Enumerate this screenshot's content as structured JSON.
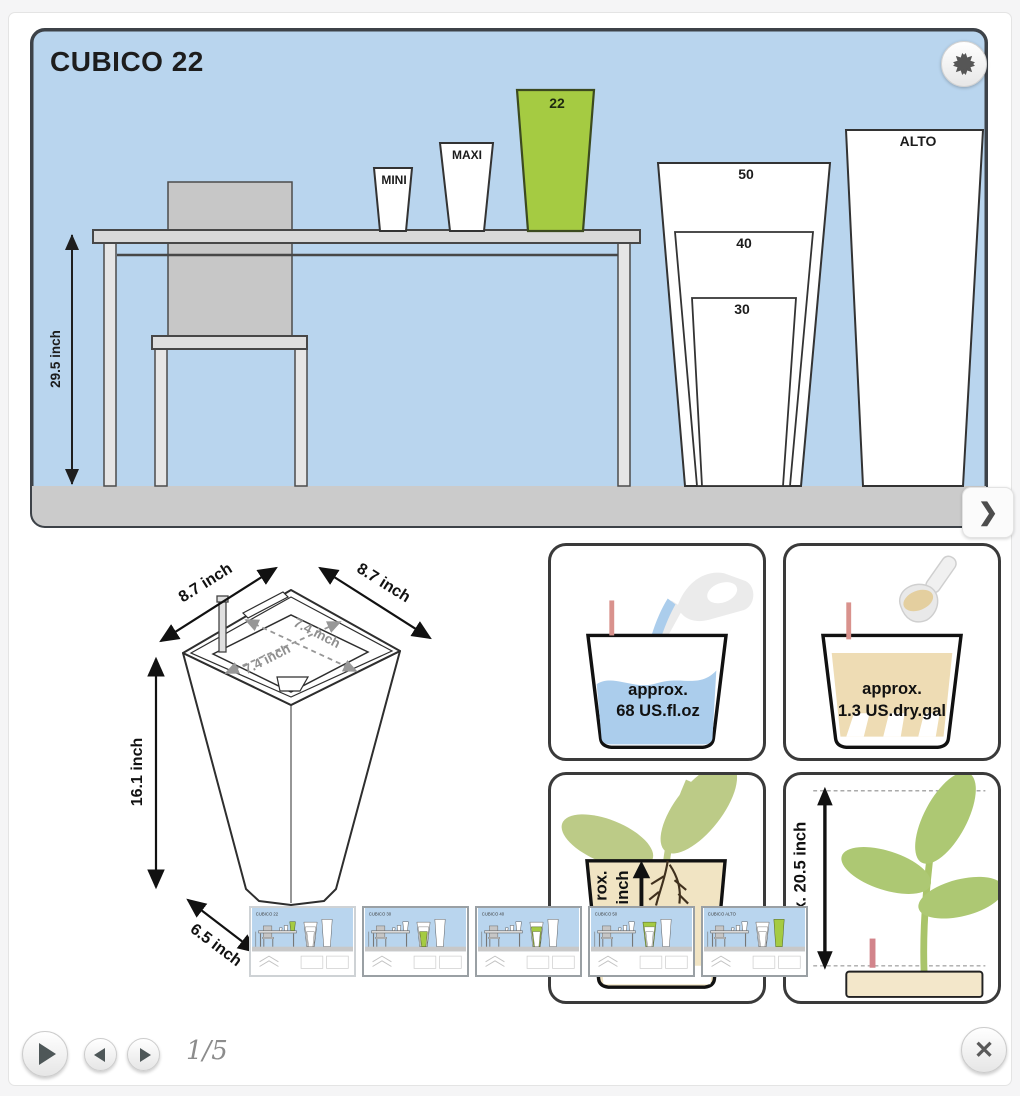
{
  "slide": {
    "title": "CUBICO 22",
    "height_dimension": "29.5 inch",
    "planters": {
      "mini": "MINI",
      "maxi": "MAXI",
      "c22": "22",
      "c30": "30",
      "c40": "40",
      "c50": "50",
      "alto": "ALTO"
    }
  },
  "drawing": {
    "top_width": "8.7 inch",
    "top_depth": "8.7 inch",
    "inner_width": "7.4 inch",
    "inner_depth": "7.4 inch",
    "height": "16.1 inch",
    "base_width": "6.5 inch"
  },
  "cards": {
    "water": {
      "line1": "approx.",
      "line2": "68 US.fl.oz"
    },
    "soil": {
      "line1": "approx.",
      "line2": "1.3 US.dry.gal"
    },
    "root": {
      "fragment1": "rox.",
      "fragment2": "inch"
    },
    "plant": {
      "label": "max. 20.5 inch"
    }
  },
  "thumbnails": [
    {
      "label": "CUBICO 22"
    },
    {
      "label": "CUBICO 30"
    },
    {
      "label": "CUBICO 40"
    },
    {
      "label": "CUBICO 50"
    },
    {
      "label": "CUBICO ALTO"
    }
  ],
  "controls": {
    "pager": "1/5"
  },
  "icons": {
    "expand": "expand-arrows",
    "advance": "❯",
    "play": "play-triangle",
    "prev": "triangle-left",
    "next": "triangle-right",
    "close": "✕"
  },
  "colors": {
    "accent_green": "#a5cb42",
    "sky_blue": "#b9d5ee",
    "water_blue": "#abcdec",
    "soil_tan": "#eedcb4",
    "plant_green": "#b3c879",
    "indicator_red": "#d9928d"
  }
}
